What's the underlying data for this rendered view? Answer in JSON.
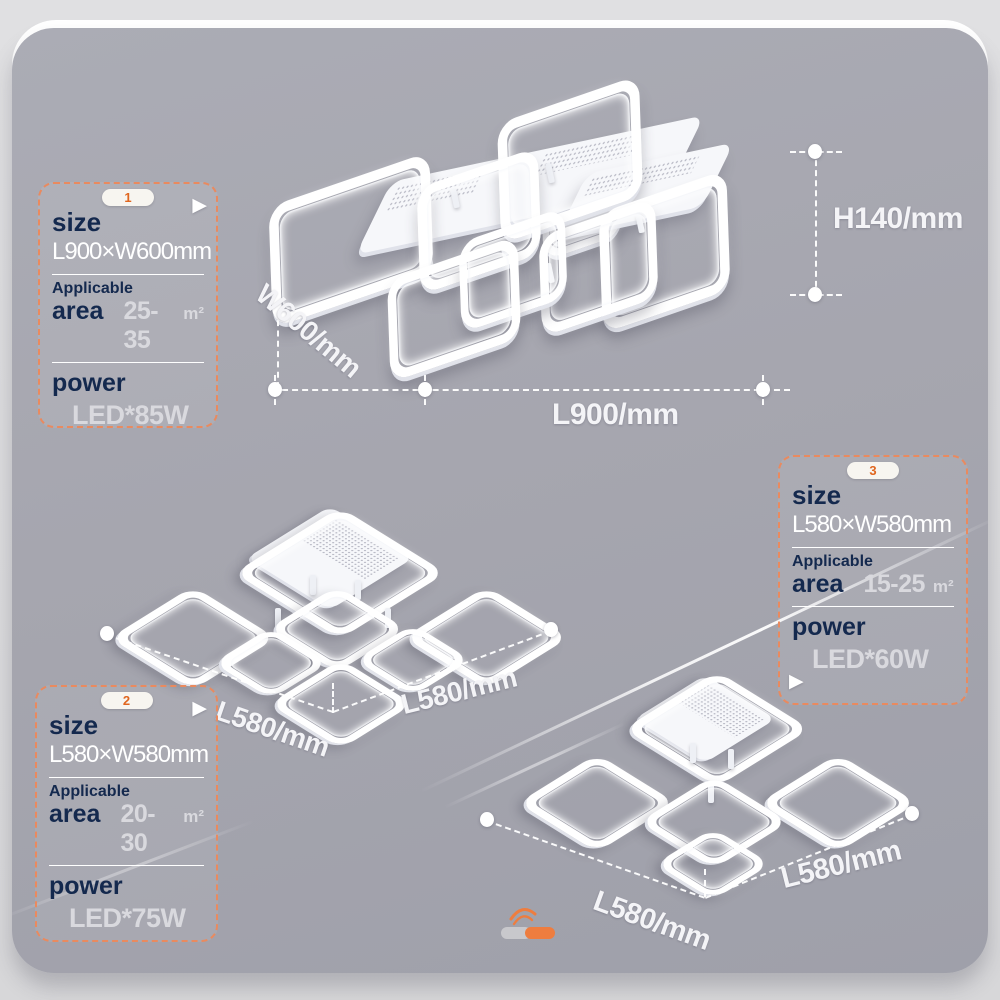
{
  "colors": {
    "page_bg": "#dcdcde",
    "card_bg": "#a6a6af",
    "accent_orange": "#e98a5f",
    "badge_orange": "#e0661f",
    "navy": "#14294e",
    "value_gray": "#d9d9de",
    "white": "#ffffff",
    "logo_gray": "#c8c8cc",
    "logo_orange": "#ee7d3f"
  },
  "icons": {
    "play_arrow": "▶"
  },
  "spec_boxes": [
    {
      "badge": "1",
      "size_label": "size",
      "size_value": "L900×W600mm",
      "area_label_top": "Applicable",
      "area_label": "area",
      "area_value": "25-35",
      "area_unit": "m²",
      "power_label": "power",
      "power_value": "LED*85W"
    },
    {
      "badge": "2",
      "size_label": "size",
      "size_value": "L580×W580mm",
      "area_label_top": "Applicable",
      "area_label": "area",
      "area_value": "20-30",
      "area_unit": "m²",
      "power_label": "power",
      "power_value": "LED*75W"
    },
    {
      "badge": "3",
      "size_label": "size",
      "size_value": "L580×W580mm",
      "area_label_top": "Applicable",
      "area_label": "area",
      "area_value": "15-25",
      "area_unit": "m²",
      "power_label": "power",
      "power_value": "LED*60W"
    }
  ],
  "dimensions": {
    "lamp1_width": "W600/mm",
    "lamp1_length": "L900/mm",
    "lamp1_height": "H140/mm",
    "lamp2_left": "L580/mm",
    "lamp2_right": "L580/mm",
    "lamp3_left": "L580/mm",
    "lamp3_right": "L580/mm"
  }
}
